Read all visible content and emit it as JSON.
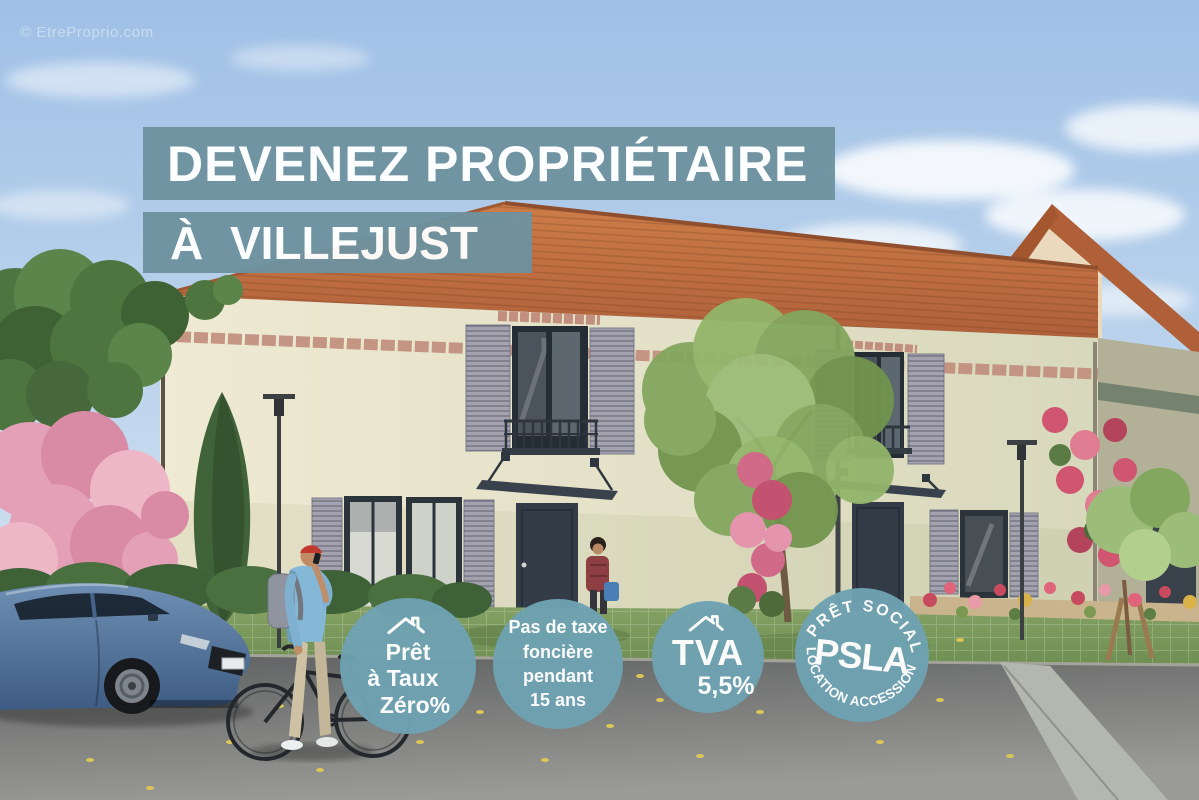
{
  "watermark": "© EtreProprio.com",
  "banners": {
    "headline": "DEVENEZ PROPRIÉTAIRE",
    "location": "À VILLEJUST"
  },
  "badges": {
    "ptz": {
      "icon": "house-roof-icon",
      "lines": [
        "Prêt",
        "à Taux",
        "Zéro%"
      ]
    },
    "tax": {
      "lines": [
        "Pas de taxe",
        "foncière",
        "pendant",
        "15 ans"
      ]
    },
    "tva": {
      "icon": "house-roof-icon",
      "title": "TVA",
      "value": "5,5%"
    },
    "psla": {
      "arc_top": "PRÊT SOCIAL",
      "center": "PSLA",
      "arc_bottom": "LOCATION ACCESSION"
    }
  },
  "colors": {
    "banner_bg": "#6e929f",
    "badge_bg": "#6fa2b2",
    "overlay_text": "#ffffff",
    "roof_tile": "#c1703f",
    "facade": "#e9e5cc",
    "sky_top": "#a3c3e8"
  }
}
